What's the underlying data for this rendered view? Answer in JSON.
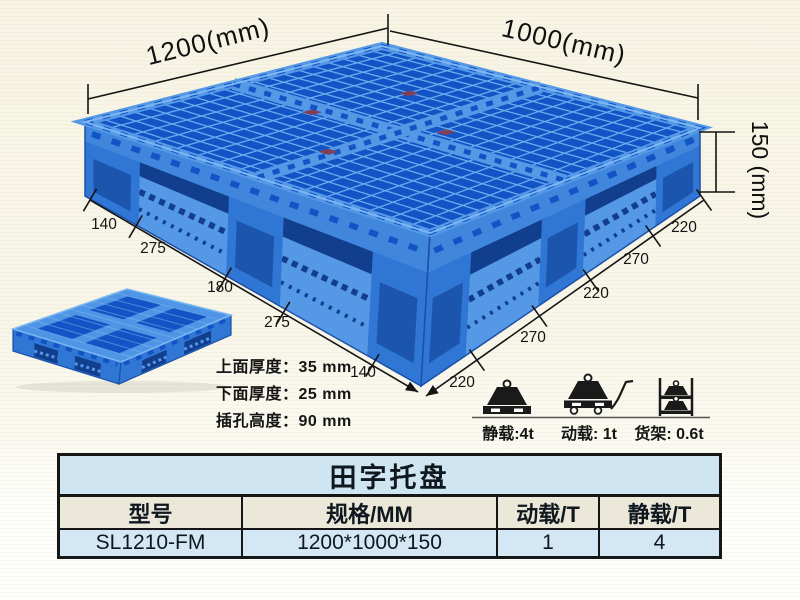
{
  "diagram": {
    "width_label": "1200(mm)",
    "depth_label": "1000(mm)",
    "height_label": "150 (mm)",
    "left_edge_dims": [
      "140",
      "275",
      "180",
      "275",
      "140"
    ],
    "right_edge_dims": [
      "220",
      "270",
      "220",
      "270",
      "220"
    ],
    "thickness_lines": [
      "上面厚度：35 mm",
      "下面厚度：25 mm",
      "插孔高度：90 mm"
    ],
    "load_ratings": [
      {
        "icon": "static-load-icon",
        "label": "静载:4t"
      },
      {
        "icon": "dynamic-load-icon",
        "label": "动载: 1t"
      },
      {
        "icon": "rack-load-icon",
        "label": "货架: 0.6t"
      }
    ],
    "colors": {
      "top_hole": "#1254c6",
      "rib_light": "#6aabee",
      "side_mid": "#3076d4",
      "deck_band": "#3f86dc",
      "rail_light": "#5598e6",
      "recess_dark": "#123e8e",
      "leg_inner": "#1c55ae",
      "rim_highlight": "#7cb6f3",
      "outline": "#1b4fa8",
      "tag_red": "#7d3f5a"
    }
  },
  "spec_table": {
    "title": "田字托盘",
    "columns": [
      "型号",
      "规格/MM",
      "动载/T",
      "静载/T"
    ],
    "rows": [
      [
        "SL1210-FM",
        "1200*1000*150",
        "1",
        "4"
      ]
    ]
  }
}
